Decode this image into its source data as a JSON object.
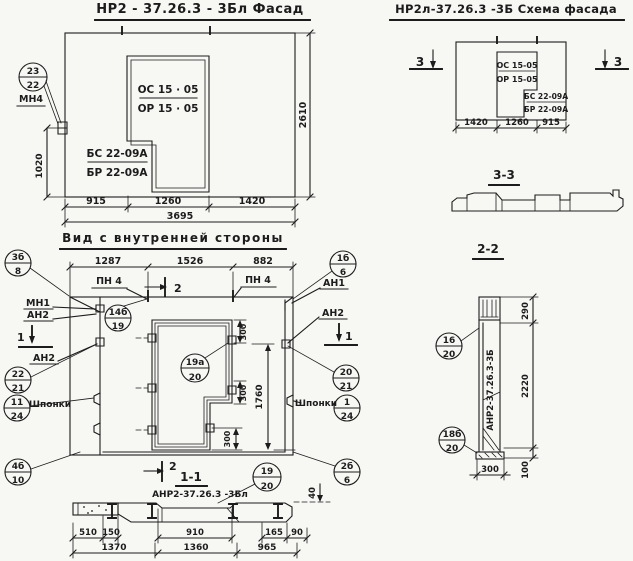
{
  "facade": {
    "title": "НР2 - 37.26.3  - 3Бл  Фасад",
    "window_top": "ОС 15 · 05",
    "window_bottom": "ОР 15 · 05",
    "block_top": "БС 22-09А",
    "block_bottom": "БР 22-09А",
    "callout": {
      "top": "23",
      "bottom": "22",
      "label": "МН4"
    },
    "dims": {
      "d915": "915",
      "d1260": "1260",
      "d1420": "1420",
      "total": "3695",
      "height": "2610",
      "left": "1020"
    }
  },
  "scheme": {
    "title": "НР2л-37.26.3  -3Б  Схема фасада",
    "window_top": "ОС 15-05",
    "window_bottom": "ОР 15-05",
    "block_top": "БС 22-09А",
    "block_bottom": "БР 22-09А",
    "marker": "3",
    "dims": {
      "d1420": "1420",
      "d1260": "1260",
      "d915": "915"
    }
  },
  "section33": {
    "title": "3-3"
  },
  "section22": {
    "title": "2-2",
    "label": "АНР2-37.26.3-3Б",
    "callout_16_20": {
      "top": "16",
      "bottom": "20"
    },
    "callout_18b_20": {
      "top": "18б",
      "bottom": "20"
    },
    "dims": {
      "d290": "290",
      "d2220": "2220",
      "d100": "100",
      "d300": "300"
    }
  },
  "inner": {
    "title": "Вид с внутренней стороны",
    "labels": {
      "pn4": "ПН 4",
      "mn1": "МН1",
      "an1": "АН1",
      "an2": "АН2",
      "shponki": "Шпонки",
      "m1": "1",
      "m2": "2"
    },
    "callouts": {
      "c3b_8": {
        "top": "3б",
        "bottom": "8"
      },
      "c14b_19": {
        "top": "14б",
        "bottom": "19"
      },
      "c1b_6": {
        "top": "1б",
        "bottom": "6"
      },
      "c22_21": {
        "top": "22",
        "bottom": "21"
      },
      "c11_24": {
        "top": "11",
        "bottom": "24"
      },
      "c4b_10": {
        "top": "4б",
        "bottom": "10"
      },
      "c19a_20": {
        "top": "19а",
        "bottom": "20"
      },
      "c20_21": {
        "top": "20",
        "bottom": "21"
      },
      "c1_24": {
        "top": "1",
        "bottom": "24"
      },
      "c2b_6": {
        "top": "2б",
        "bottom": "6"
      }
    },
    "dims": {
      "d1287": "1287",
      "d1526": "1526",
      "d882": "882",
      "d300": "300",
      "d1760": "1760"
    }
  },
  "section11": {
    "title": "1-1",
    "label": "АНР2-37.26.3 -3Бл",
    "marker": "2",
    "callout_19_20": {
      "top": "19",
      "bottom": "20"
    },
    "dims": {
      "d510": "510",
      "d150": "150",
      "d910": "910",
      "d165": "165",
      "d90": "90",
      "d1370": "1370",
      "d1360": "1360",
      "d965": "965",
      "d40": "40"
    }
  }
}
